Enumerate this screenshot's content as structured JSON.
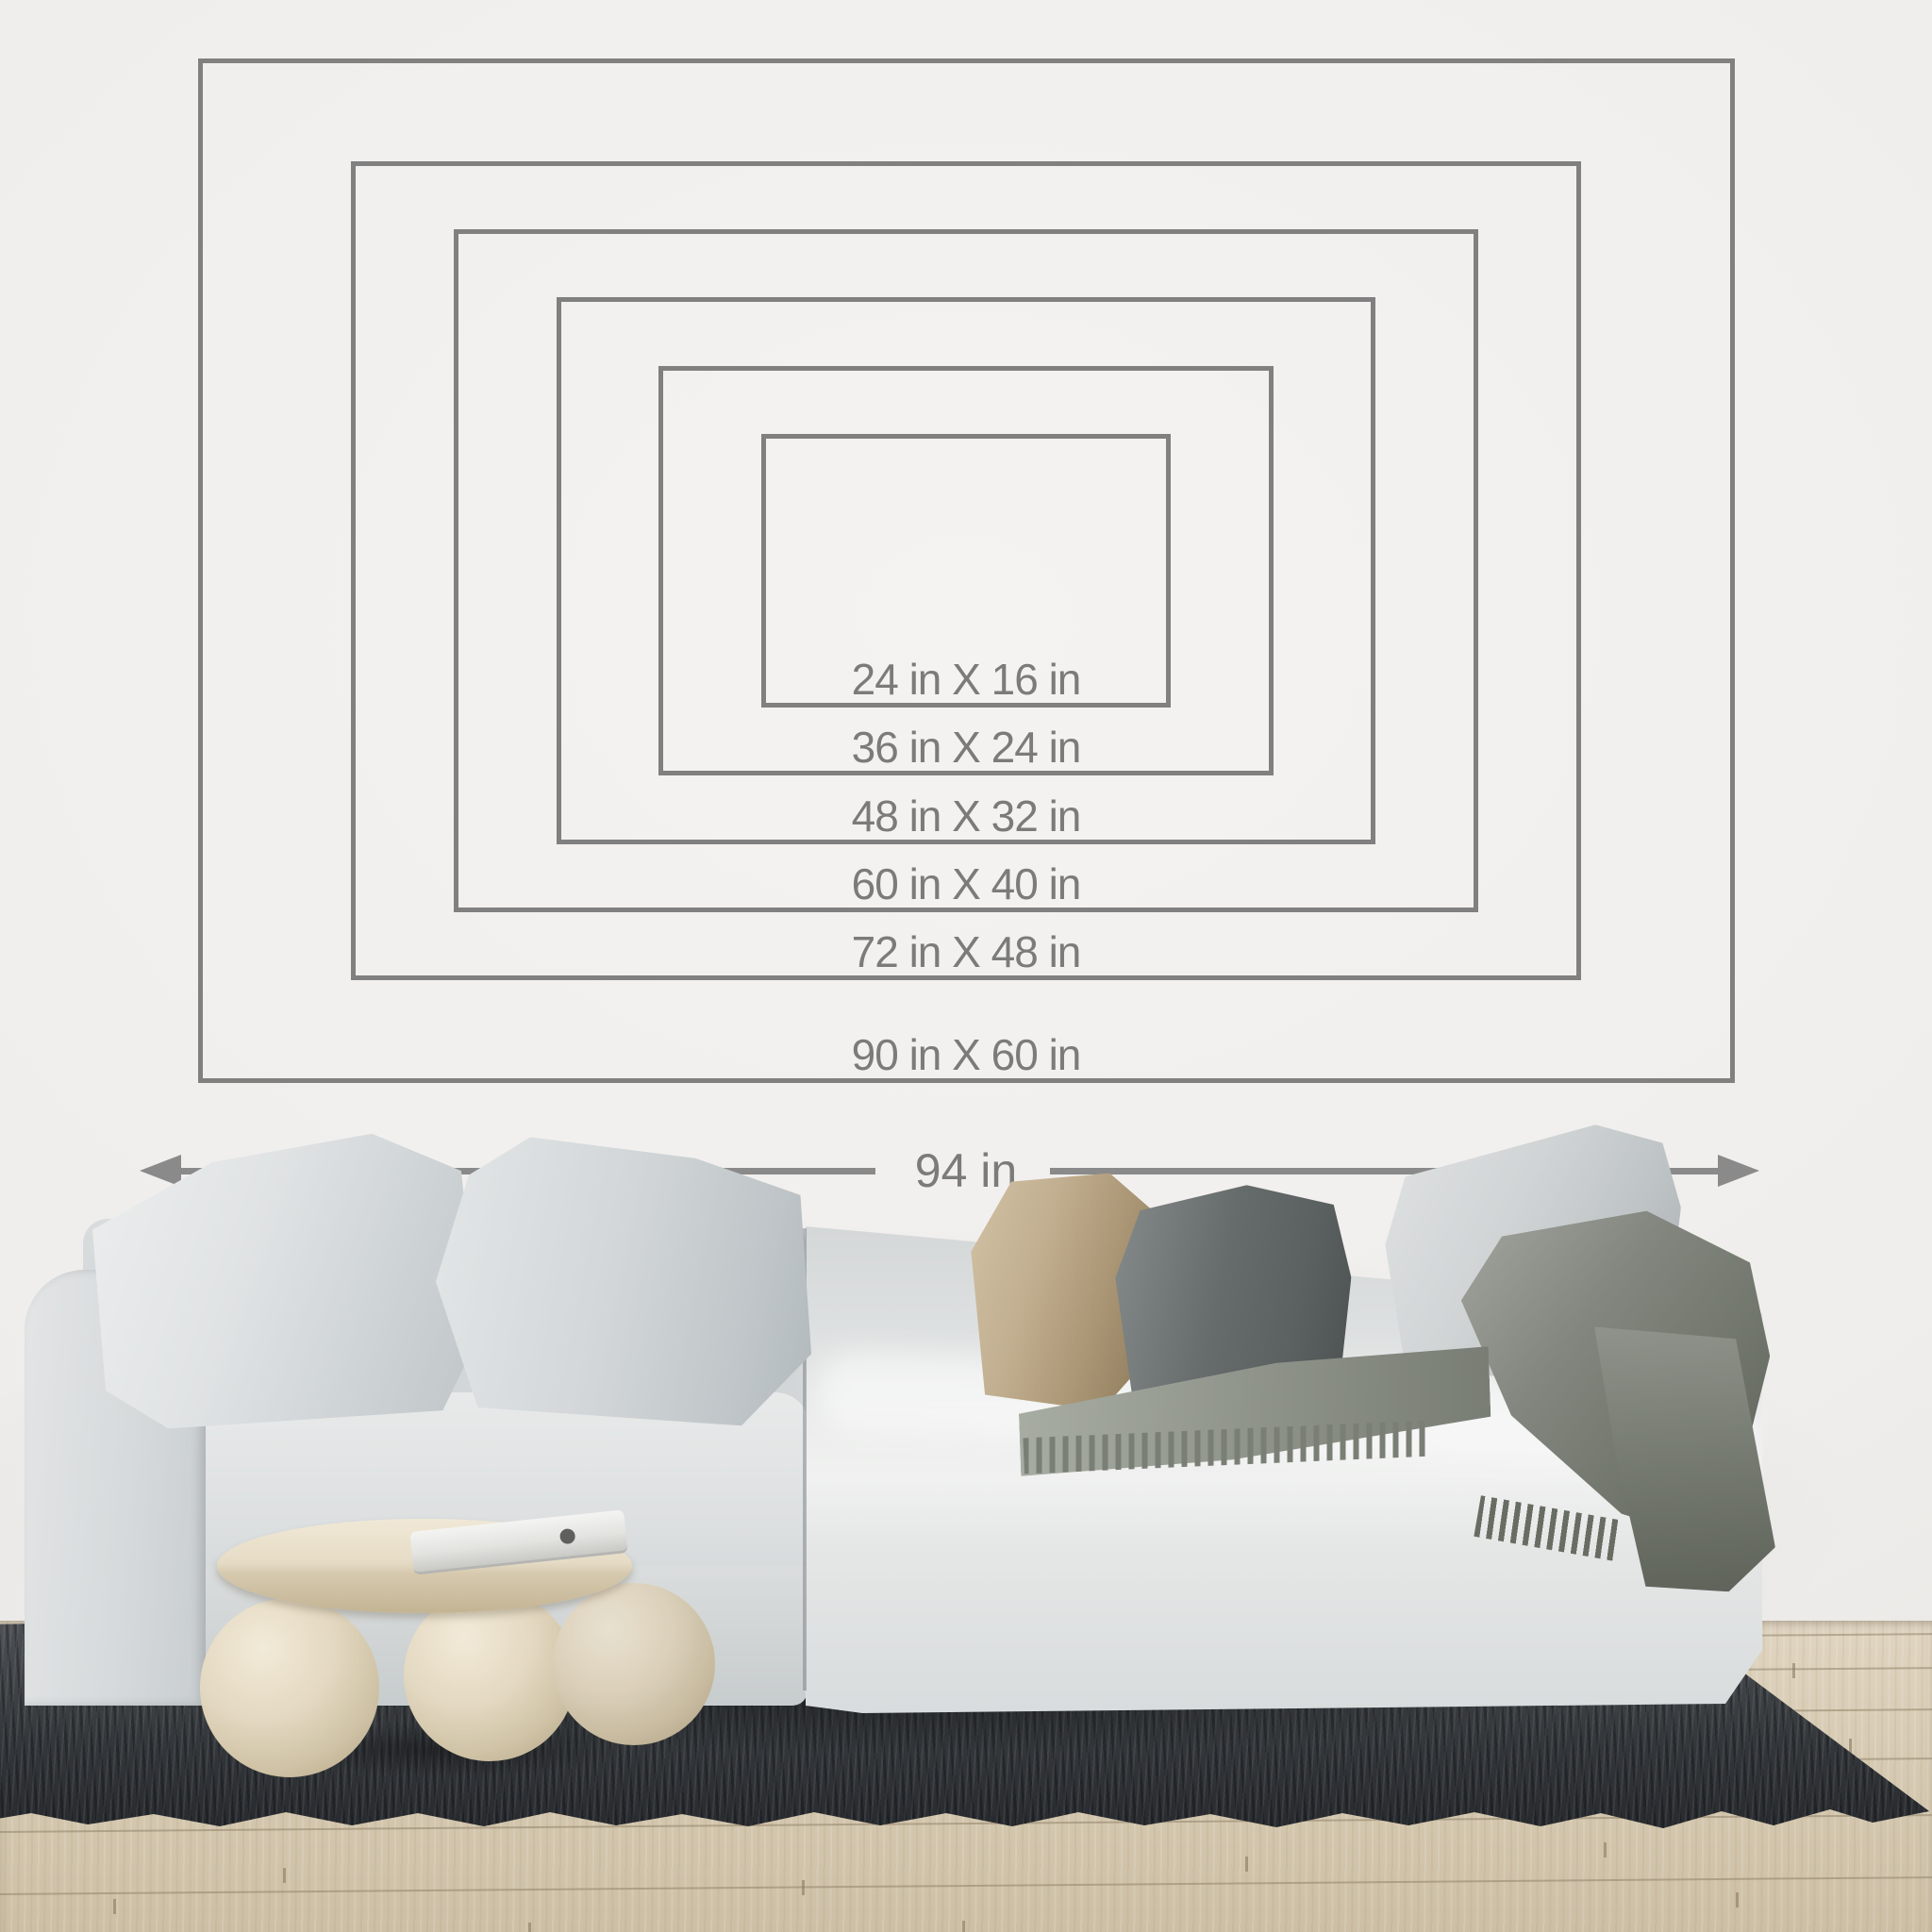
{
  "size_chart": {
    "unit": "in",
    "sizes": [
      {
        "id": "24x16",
        "label": "24 in X 16 in",
        "width_in": 24,
        "height_in": 16
      },
      {
        "id": "36x24",
        "label": "36 in X 24 in",
        "width_in": 36,
        "height_in": 24
      },
      {
        "id": "48x32",
        "label": "48 in X 32 in",
        "width_in": 48,
        "height_in": 32
      },
      {
        "id": "60x40",
        "label": "60 in X 40 in",
        "width_in": 60,
        "height_in": 40
      },
      {
        "id": "72x48",
        "label": "72 in X 48 in",
        "width_in": 72,
        "height_in": 48
      },
      {
        "id": "90x60",
        "label": "90 in X 60 in",
        "width_in": 90,
        "height_in": 60
      }
    ],
    "wall_width": {
      "label": "94 in",
      "inches": 94
    }
  },
  "colors": {
    "outline": "#808080",
    "label_text": "#7b7b7b",
    "arrow": "#8a8a8a",
    "wall": "#f0eeec",
    "floor_wood": "#d5c8b1",
    "rug": "#34383c",
    "sofa_fabric": "#dcdfe0",
    "pillow_beige": "#c2af91",
    "pillow_dark_gray": "#666b6b",
    "throw_gray_green": "#82867e",
    "table_cream": "#e6dcc6"
  },
  "scene": {
    "objects": [
      "nested-size-rectangles",
      "width-dimension-arrow",
      "sofa",
      "cushions",
      "throw-blanket",
      "round-coffee-table",
      "laptop",
      "shag-rug",
      "wood-floor",
      "white-wall"
    ]
  }
}
